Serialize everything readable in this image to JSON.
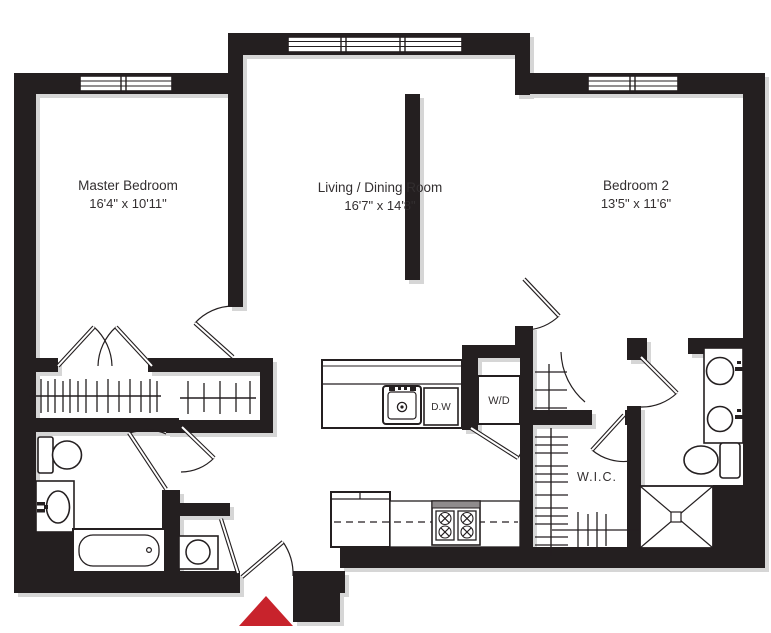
{
  "colors": {
    "walls": "#241f20",
    "entrance_marker": "#c8232c",
    "background": "#ffffff",
    "shadow": "#d6d6d6"
  },
  "rooms": [
    {
      "name": "Master Bedroom",
      "dimensions": "16'4\" x 10'11\""
    },
    {
      "name": "Living / Dining Room",
      "dimensions": "16'7\" x 14'8\""
    },
    {
      "name": "Bedroom 2",
      "dimensions": "13'5\" x 11'6\""
    },
    {
      "name": "W.I.C."
    }
  ],
  "labels": {
    "washer_dryer": "W/D",
    "dishwasher": "D.W"
  }
}
